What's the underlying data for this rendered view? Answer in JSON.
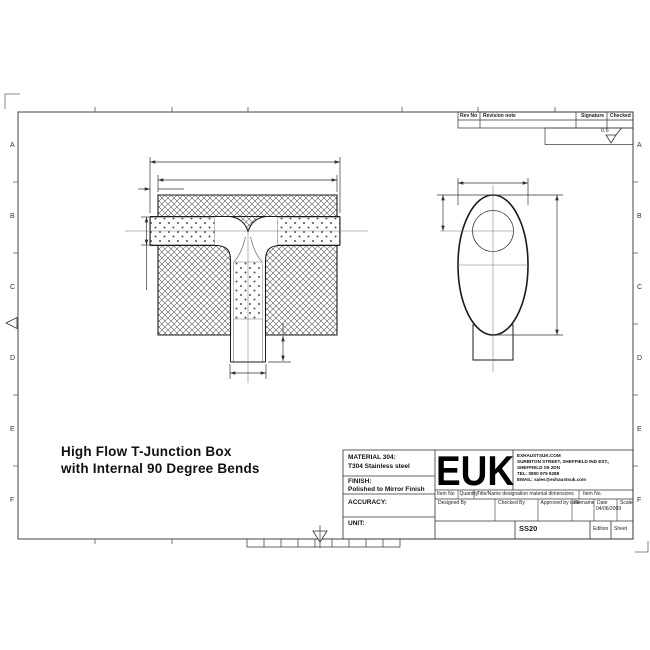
{
  "drawing_title": {
    "line1": "High Flow T-Junction Box",
    "line2": "with Internal 90 Degree Bends"
  },
  "revision_table": {
    "rev_no": "Rev No",
    "revision_note": "Revision note",
    "signature": "Signature",
    "checked": "Checked"
  },
  "surface_finish": {
    "value": "0.6"
  },
  "frame": {
    "zone_letters": [
      "A",
      "B",
      "C",
      "D",
      "E",
      "F"
    ]
  },
  "title_block": {
    "material_label": "MATERIAL 304:",
    "material_value": "T304 Stainless steel",
    "finish_label": "FINISH:",
    "finish_value": "Polished to Mirror Finish",
    "accuracy_label": "ACCURACY:",
    "unit_label": "UNIT:",
    "logo": "EUK",
    "company": {
      "line1": "EXHAUSTSUK.COM",
      "line2": "SURBITON STREET, SHEFFIELD IND EST.,",
      "line3": "SHEFFIELD S9 2DN",
      "line4": "TEL: 0800 975 9288",
      "line5": "EMAIL: sales@exhaustsuk.com"
    },
    "row_headers": {
      "item_no": "Item No",
      "quantity": "Quantity",
      "title_name": "Title/Name designation material dimensions",
      "item_no2": "Item No."
    },
    "approval": {
      "designed_by": "Designed By",
      "checked_by": "Checked By",
      "approved_by": "Approved by date",
      "filename": "Filename",
      "date_label": "Date",
      "date_value": "04/06/2009",
      "scale_label": "Scale",
      "doc_number": "SS20",
      "edition_label": "Edition",
      "sheet_label": "Sheet"
    }
  },
  "colors": {
    "line": "#1a1a1a",
    "dim": "#333333",
    "hatch": "#444444"
  }
}
